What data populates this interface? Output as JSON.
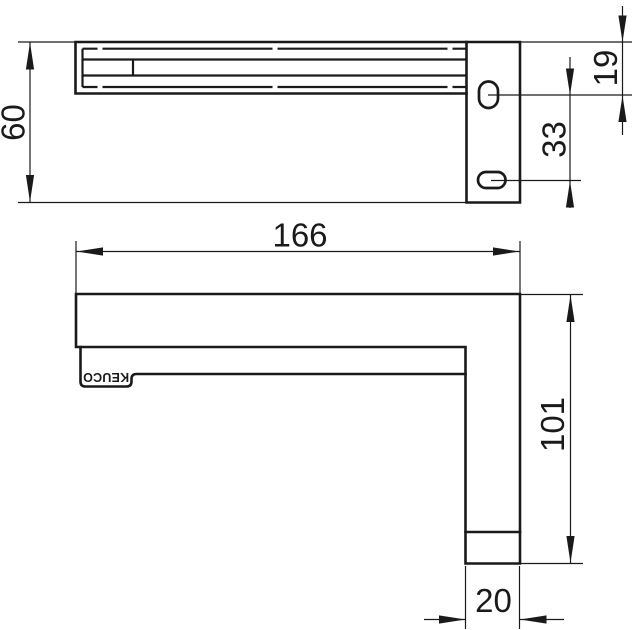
{
  "canvas": {
    "background": "#ffffff",
    "line_color": "#1a1a1a"
  },
  "drawing": {
    "brand": "KEUCO",
    "views": {
      "top": {
        "dims": {
          "depth": "60",
          "slot_top_offset": "19",
          "slot_spacing": "33"
        }
      },
      "side": {
        "dims": {
          "length": "166",
          "height": "101",
          "profile_width": "20"
        }
      }
    }
  }
}
